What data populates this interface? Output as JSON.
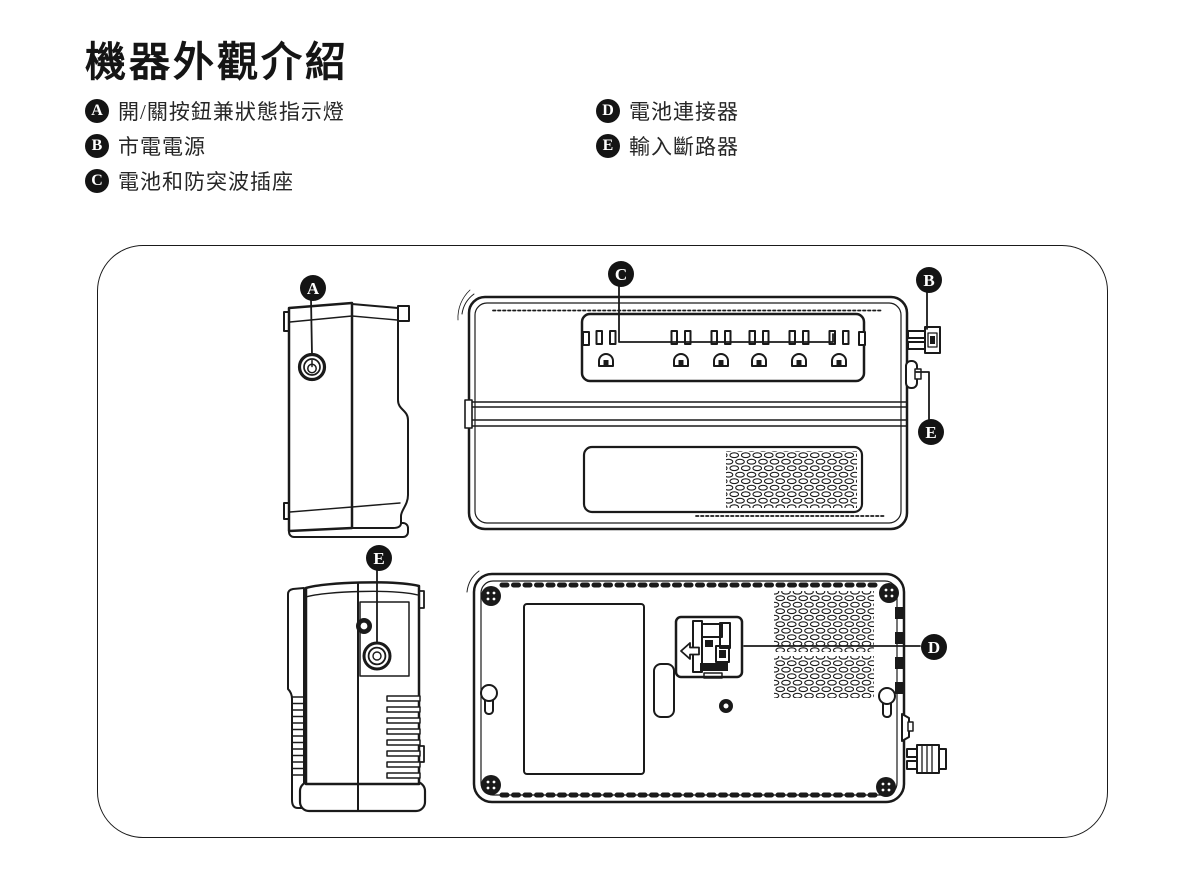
{
  "title": "機器外觀介紹",
  "legend": {
    "left": [
      {
        "letter": "A",
        "label": "開/關按鈕兼狀態指示燈"
      },
      {
        "letter": "B",
        "label": "市電電源"
      },
      {
        "letter": "C",
        "label": "電池和防突波插座"
      }
    ],
    "right": [
      {
        "letter": "D",
        "label": "電池連接器"
      },
      {
        "letter": "E",
        "label": "輸入斷路器"
      }
    ]
  },
  "diagram": {
    "callouts": {
      "a": "A",
      "b": "B",
      "c": "C",
      "d": "D",
      "e": "E"
    }
  },
  "colors": {
    "line": "#1a1a1a",
    "badge_bg": "#141414",
    "background": "#ffffff"
  }
}
